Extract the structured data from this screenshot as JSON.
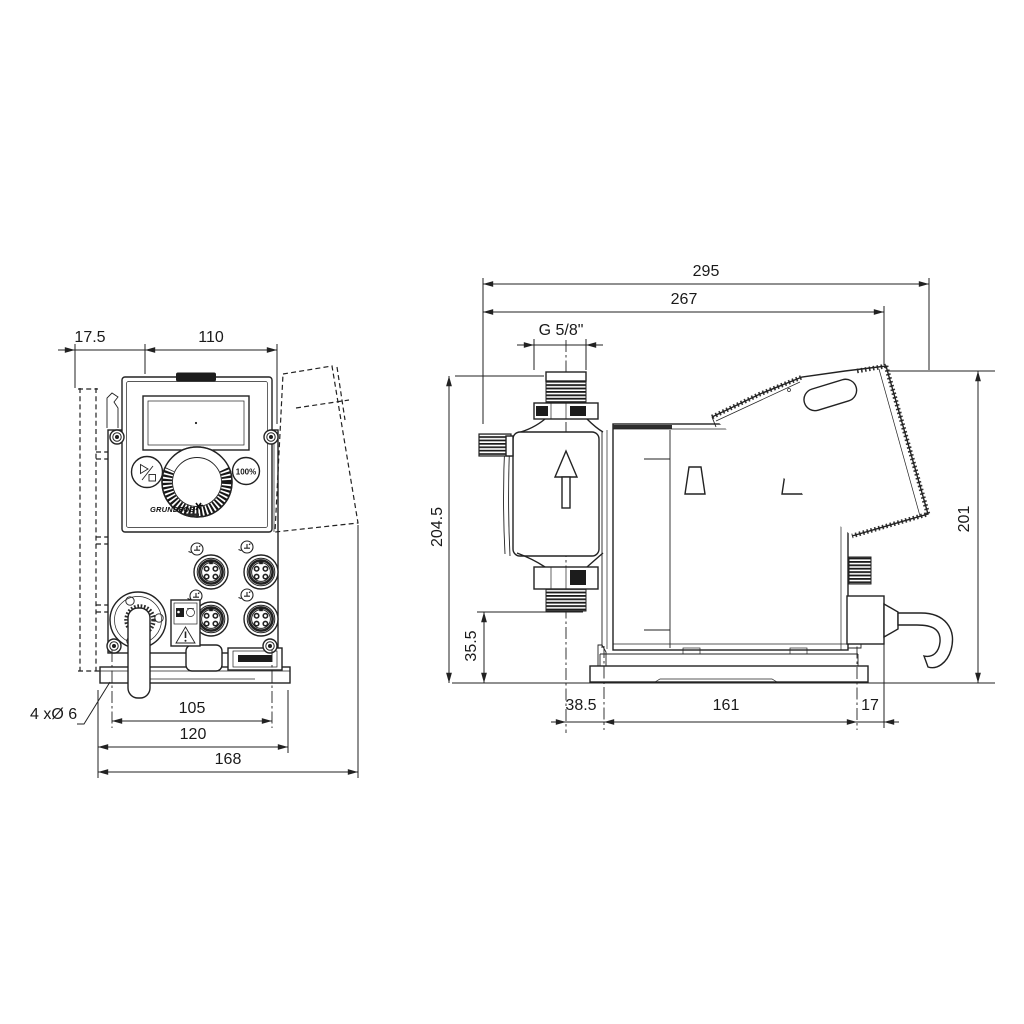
{
  "drawing": {
    "type": "technical-dimension-drawing",
    "units": "mm",
    "front_view": {
      "dim_offset_left": "17.5",
      "dim_panel_width": "110",
      "dim_hole_spacing": "105",
      "dim_plate_width": "120",
      "dim_overall_width": "168",
      "callout_mounting_holes": "4 xØ 6",
      "button_100_label": "100%",
      "logo_text": "GRUNDFOS"
    },
    "side_view": {
      "dim_overall_depth": "295",
      "dim_depth_to_panel": "267",
      "dim_thread_size": "G 5/8\"",
      "dim_height_valve": "204.5",
      "dim_valve_clearance": "35.5",
      "dim_valve_offset": "38.5",
      "dim_base_length": "161",
      "dim_base_end": "17",
      "dim_overall_height": "201"
    }
  },
  "colors": {
    "line": "#222222",
    "background": "#ffffff"
  }
}
